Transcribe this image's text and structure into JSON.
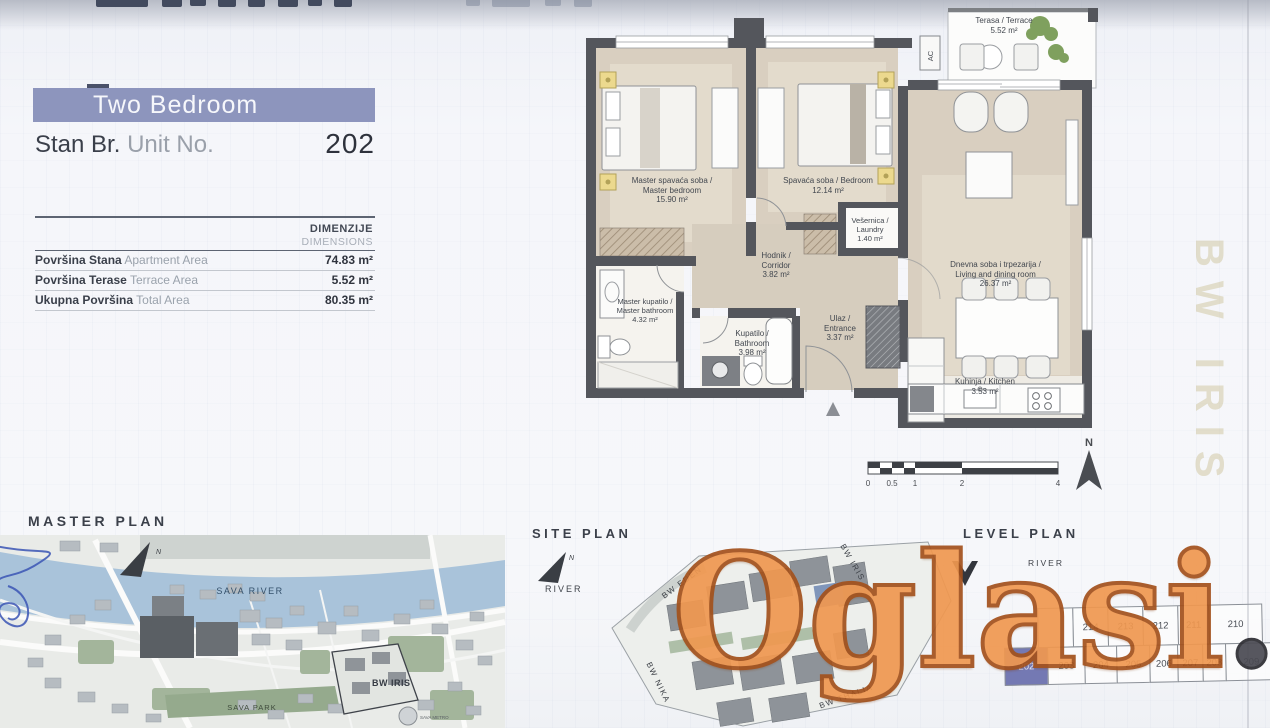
{
  "header": {
    "unit_type": "Two Bedroom",
    "unit_no_sr": "Stan Br.",
    "unit_no_en": "Unit No.",
    "unit_number": "202"
  },
  "dimensions": {
    "header_sr": "DIMENZIJE",
    "header_en": "DIMENSIONS",
    "rows": [
      {
        "sr": "Površina Stana",
        "en": "Apartment Area",
        "value": "74.83 m²"
      },
      {
        "sr": "Površina Terase",
        "en": "Terrace Area",
        "value": "5.52 m²"
      },
      {
        "sr": "Ukupna Površina",
        "en": "Total Area",
        "value": "80.35 m²"
      }
    ]
  },
  "floor_plan": {
    "rooms": [
      {
        "l1": "Master spavaća soba /",
        "l2": "Master bedroom",
        "l3": "15.90 m²"
      },
      {
        "l1": "Spavaća soba / Bedroom",
        "l3": "12.14 m²"
      },
      {
        "l1": "Vešernica /",
        "l2": "Laundry",
        "l3": "1.40 m²"
      },
      {
        "l1": "Hodnik /",
        "l2": "Corridor",
        "l3": "3.82 m²"
      },
      {
        "l1": "Master kupatilo /",
        "l2": "Master bathroom",
        "l3": "4.32 m²"
      },
      {
        "l1": "Kupatilo /",
        "l2": "Bathroom",
        "l3": "3.98 m²"
      },
      {
        "l1": "Ulaz /",
        "l2": "Entrance",
        "l3": "3.37 m²"
      },
      {
        "l1": "Dnevna soba i trpezarija /",
        "l2": "Living and dining room",
        "l3": "26.37 m²"
      },
      {
        "l1": "Kuhinja / Kitchen",
        "l3": "3.53 m²"
      },
      {
        "l1": "Terasa / Terrace",
        "l3": "5.52 m²"
      }
    ],
    "ac_label": "AC",
    "north": "N",
    "scale_ticks": [
      "0",
      "0.5",
      "1",
      "2",
      "4"
    ]
  },
  "master_plan": {
    "title": "MASTER PLAN",
    "north": "N",
    "river": "SAVA RIVER",
    "park": "SAVA PARK",
    "site": "BW IRIS",
    "metro": "SAVA METRO"
  },
  "site_plan": {
    "title": "SITE PLAN",
    "north": "N",
    "river": "RIVER",
    "buildings": [
      "BW EDEN",
      "BW IRIS",
      "BW NIKA",
      "BW THALIA"
    ]
  },
  "level_plan": {
    "title": "LEVEL PLAN",
    "river": "RIVER",
    "top_row": [
      "",
      "214",
      "213",
      "212",
      "211",
      "210"
    ],
    "bottom_row": [
      "202",
      "203",
      "204",
      "205",
      "206",
      "207",
      "208",
      "209"
    ],
    "highlighted_unit": "202"
  },
  "watermark": {
    "orange": "Oglasi",
    "dark": ".rs"
  },
  "side_text": "BW IRIS",
  "colors": {
    "banner": "#8d95bd",
    "floor": "#d9cfc0",
    "wall": "#54565c",
    "river": "#a9c3da",
    "highlight_unit": "#7479b3",
    "watermark_orange": "#f09850"
  }
}
